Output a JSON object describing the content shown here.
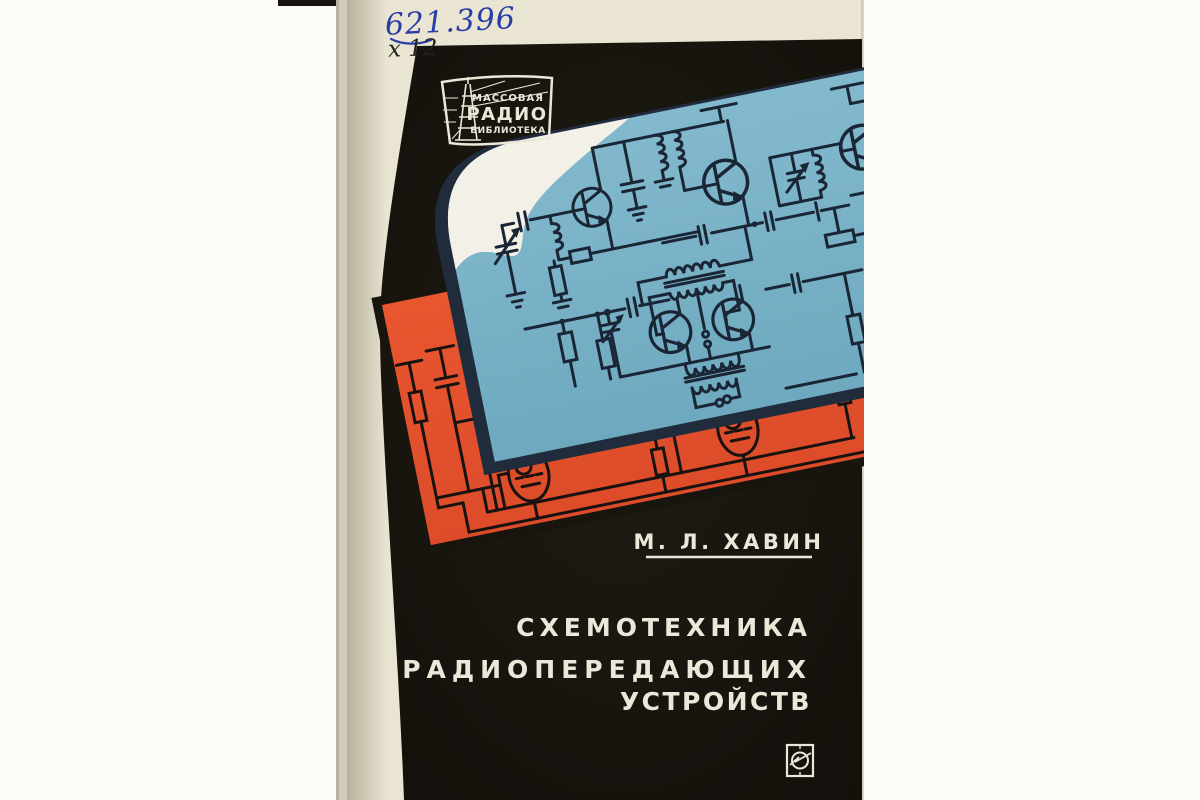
{
  "photo": {
    "description": "Photograph of a printed book front cover, light margins left and right",
    "background_color": "#fcfbf8"
  },
  "handwritten": {
    "catalog_number": "621.396",
    "shelf_code": "х 12",
    "ink_color": "#2a3da6"
  },
  "series_badge": {
    "line1": "МАССОВАЯ",
    "line2": "РАДИО",
    "line3": "БИБЛИОТЕКА",
    "emblem": "radio-tower-icon"
  },
  "cover": {
    "author": "М. Л. ХАВИН",
    "title_lines": [
      "СХЕМОТЕХНИКА",
      "РАДИОПЕРЕДАЮЩИХ",
      "УСТРОЙСТВ"
    ],
    "publisher_mark": "energiya-publisher-logo",
    "artwork": {
      "blue_panel": "tilted light-blue panel with transistor radio-transmitter schematic",
      "orange_panel": "tilted red-orange panel with vacuum-tube transmitter schematic",
      "white_corner": "white cloud-like area on upper-left corner of blue panel"
    },
    "colors": {
      "photo_bg": "#fcfbf8",
      "cover_black": "#18140e",
      "paper_cream": "#e9e5d2",
      "panel_blue": "#7ab2c8",
      "panel_orange": "#e5512d",
      "navy_edge": "#202c3c",
      "blob_white": "#f3f1e7",
      "ink_blue_schematic": "#1a2635",
      "ink_black_schematic": "#181310",
      "text_cream": "#ece8d9"
    }
  }
}
